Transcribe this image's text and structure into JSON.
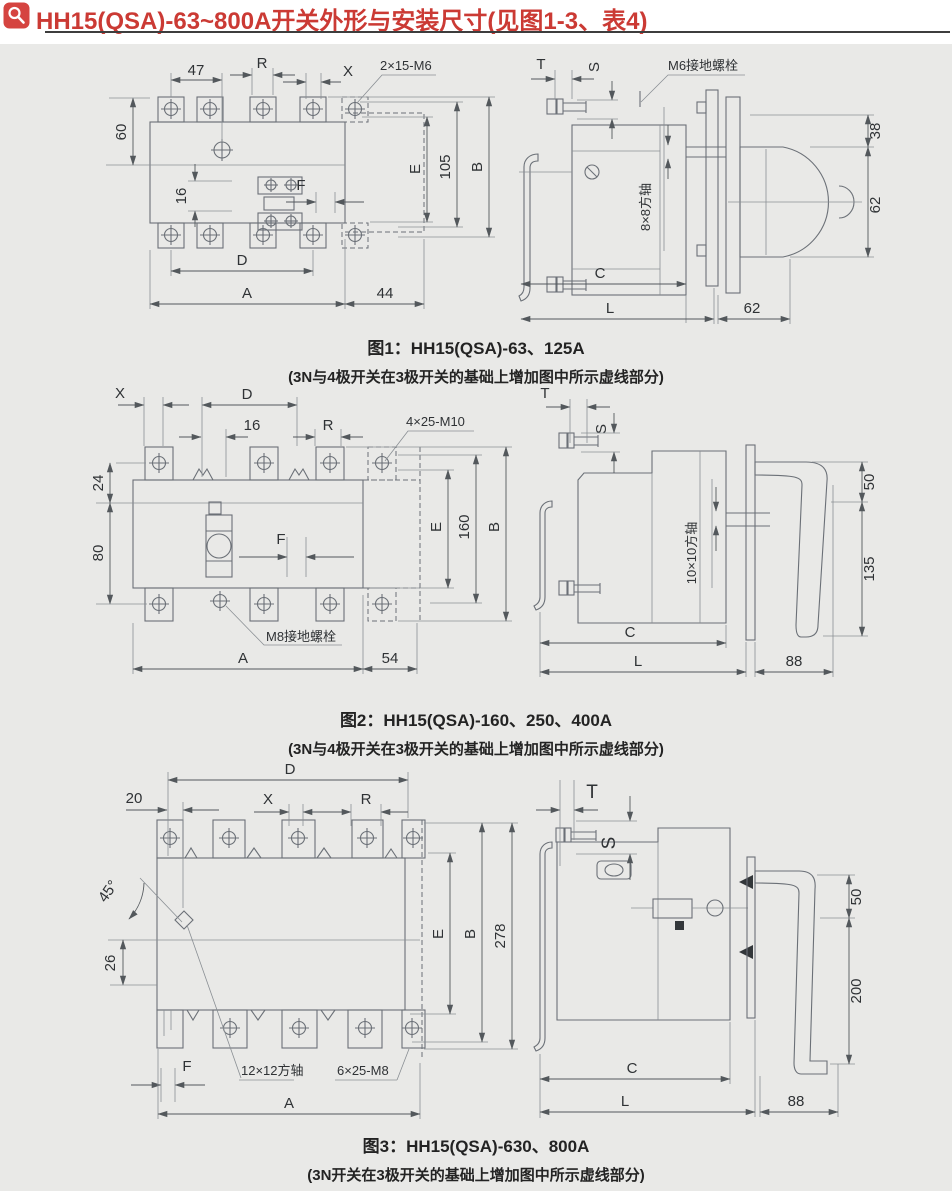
{
  "page": {
    "background": "#e9e9e7",
    "header_background": "#ffffff",
    "accent_red": "#cb3a34"
  },
  "header": {
    "title": "HH15(QSA)-63~800A开关外形与安装尺寸(见图1-3、表4)"
  },
  "fig1": {
    "caption": "图1：HH15(QSA)-63、125A",
    "note": "(3N与4极开关在3极开关的基础上增加图中所示虚线部分)",
    "front": {
      "d47": "47",
      "r": "R",
      "x": "X",
      "bolt": "2×15-M6",
      "d60": "60",
      "d16": "16",
      "f": "F",
      "e": "E",
      "d105": "105",
      "b": "B",
      "d": "D",
      "a": "A",
      "d44": "44"
    },
    "side": {
      "t": "T",
      "s": "S",
      "ground": "M6接地螺栓",
      "shaft": "8×8方轴",
      "d38": "38",
      "d62": "62",
      "c": "C",
      "l": "L",
      "d62b": "62"
    }
  },
  "fig2": {
    "caption": "图2：HH15(QSA)-160、250、400A",
    "note": "(3N与4极开关在3极开关的基础上增加图中所示虚线部分)",
    "front": {
      "x": "X",
      "d": "D",
      "d16": "16",
      "r": "R",
      "bolt": "4×25-M10",
      "d24": "24",
      "d80": "80",
      "f": "F",
      "ground": "M8接地螺栓",
      "e": "E",
      "d160": "160",
      "b": "B",
      "a": "A",
      "d54": "54"
    },
    "side": {
      "t": "T",
      "s": "S",
      "shaft": "10×10方轴",
      "d50": "50",
      "d135": "135",
      "c": "C",
      "l": "L",
      "d88": "88"
    }
  },
  "fig3": {
    "caption": "图3：HH15(QSA)-630、800A",
    "note": "(3N开关在3极开关的基础上增加图中所示虚线部分)",
    "front": {
      "d": "D",
      "d20": "20",
      "x": "X",
      "r": "R",
      "a45": "45°",
      "d26": "26",
      "e": "E",
      "b": "B",
      "d278": "278",
      "f": "F",
      "shaft": "12×12方轴",
      "bolt": "6×25-M8",
      "a": "A"
    },
    "side": {
      "t": "T",
      "s": "S",
      "d50": "50",
      "d200": "200",
      "c": "C",
      "l": "L",
      "d88": "88"
    }
  }
}
